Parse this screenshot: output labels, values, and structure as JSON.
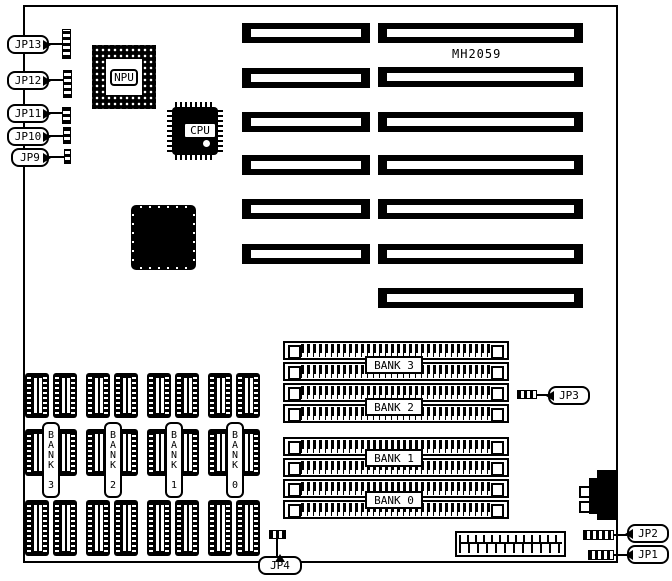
{
  "colors": {
    "ink": "#000000",
    "paper": "#ffffff"
  },
  "board": {
    "model_label": "MH2059"
  },
  "chips": {
    "npu_label": "NPU",
    "cpu_label": "CPU"
  },
  "left_jumpers": [
    {
      "label": "JP13"
    },
    {
      "label": "JP12"
    },
    {
      "label": "JP11"
    },
    {
      "label": "JP10"
    },
    {
      "label": "JP9"
    }
  ],
  "other_jumpers": {
    "jp3": {
      "label": "JP3"
    },
    "jp4": {
      "label": "JP4"
    },
    "jp2": {
      "label": "JP2"
    },
    "jp1": {
      "label": "JP1"
    }
  },
  "simm_banks": [
    {
      "label": "BANK 3"
    },
    {
      "label": "BANK 2"
    },
    {
      "label": "BANK 1"
    },
    {
      "label": "BANK 0"
    }
  ],
  "dip_banks": [
    {
      "label": "BANK 3"
    },
    {
      "label": "BANK 2"
    },
    {
      "label": "BANK 1"
    },
    {
      "label": "BANK 0"
    }
  ]
}
